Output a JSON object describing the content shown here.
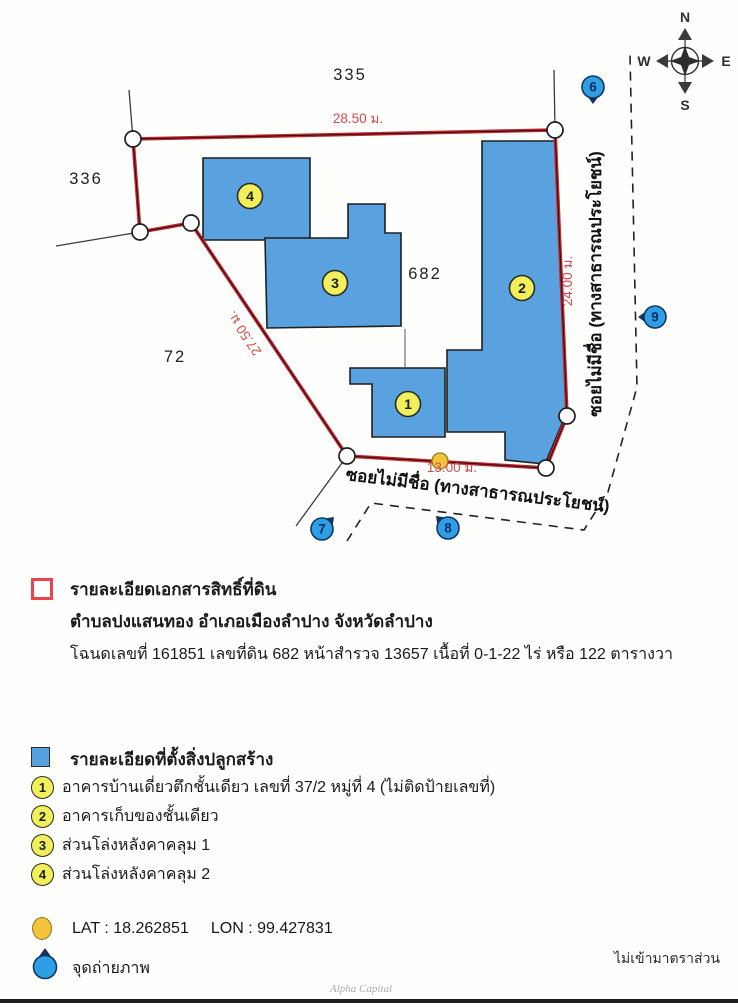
{
  "map": {
    "parcel_numbers": [
      {
        "label": "335"
      },
      {
        "label": "336"
      },
      {
        "label": "72"
      },
      {
        "label": "682"
      }
    ],
    "measurements": {
      "top": "28.50 ม.",
      "right": "24.00 ม.",
      "left_diagonal": "27.50 ม.",
      "bottom": "13.00 ม."
    },
    "street_right": "ซอยไม่มีชื่อ (ทางสาธารณประโยชน์)",
    "street_bottom": "ซอยไม่มีชื่อ (ทางสาธารณประโยชน์)",
    "compass": {
      "n": "N",
      "e": "E",
      "s": "S",
      "w": "W"
    },
    "building_markers": [
      "1",
      "2",
      "3",
      "4"
    ],
    "photo_markers": [
      "6",
      "7",
      "8",
      "9"
    ]
  },
  "deed": {
    "title": "รายละเอียดเอกสารสิทธิ์ที่ดิน",
    "location": "ตำบลปงแสนทอง อำเภอเมืองลำปาง จังหวัดลำปาง",
    "details": "โฉนดเลขที่ 161851 เลขที่ดิน 682 หน้าสำรวจ 13657 เนื้อที่ 0-1-22 ไร่ หรือ 122 ตารางวา"
  },
  "buildings": {
    "title": "รายละเอียดที่ตั้งสิ่งปลูกสร้าง",
    "items": [
      {
        "no": "1",
        "label": "อาคารบ้านเดี่ยวตึกชั้นเดียว เลขที่ 37/2 หมู่ที่ 4 (ไม่ติดป้ายเลขที่)"
      },
      {
        "no": "2",
        "label": "อาคารเก็บของชั้นเดียว"
      },
      {
        "no": "3",
        "label": "ส่วนโล่งหลังคาคลุม 1"
      },
      {
        "no": "4",
        "label": "ส่วนโล่งหลังคาคลุม 2"
      }
    ]
  },
  "footer": {
    "lat": "LAT : 18.262851",
    "lon": "LON : 99.427831",
    "photo_point": "จุดถ่ายภาพ",
    "scale_note": "ไม่เข้ามาตราส่วน",
    "watermark": "Alpha Capital"
  },
  "colors": {
    "boundary_red": "#c0272f",
    "measurement_red": "#d24a4e",
    "building_blue": "#59a2df",
    "marker_blue": "#2d9fe4",
    "marker_navy": "#16335e",
    "label_yellow": "#f1ef5a",
    "dot_yellow": "#f4c33c"
  }
}
